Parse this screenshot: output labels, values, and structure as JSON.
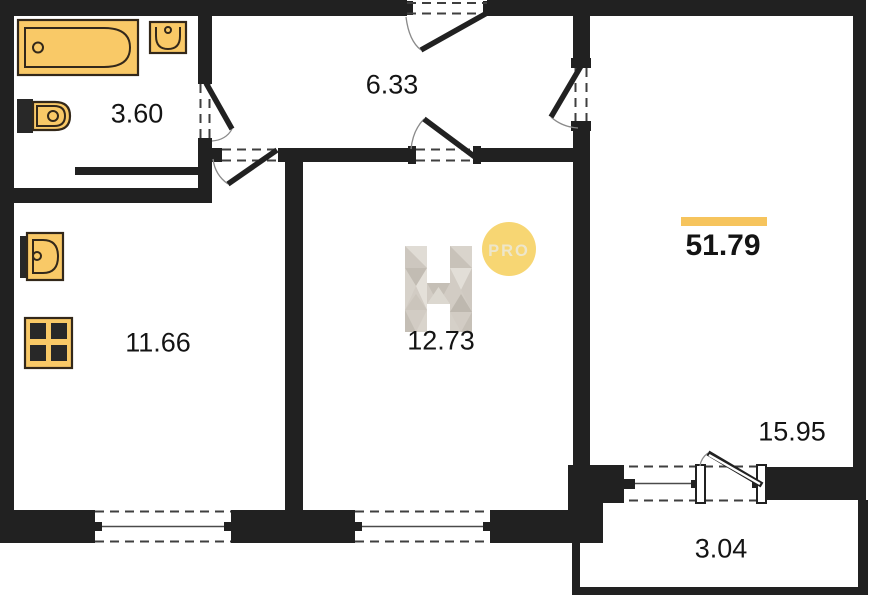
{
  "plan": {
    "total_area": "51.79",
    "rooms": [
      {
        "name": "bathroom",
        "area": "3.60"
      },
      {
        "name": "hallway",
        "area": "6.33"
      },
      {
        "name": "kitchen",
        "area": "11.66"
      },
      {
        "name": "bedroom",
        "area": "12.73"
      },
      {
        "name": "living-room",
        "area": "15.95"
      },
      {
        "name": "balcony",
        "area": "3.04"
      }
    ],
    "watermark": {
      "letter": "H",
      "badge": "PRO"
    }
  },
  "colors": {
    "wall": "#212121",
    "dash": "#3F3F3F",
    "label": "#141414",
    "accent": "#F6C45D",
    "badge": "#F7D673",
    "fixture-fill": "#F9C967",
    "fixture-stroke": "#33281A",
    "watermark-gray": "#D2CCC4"
  }
}
